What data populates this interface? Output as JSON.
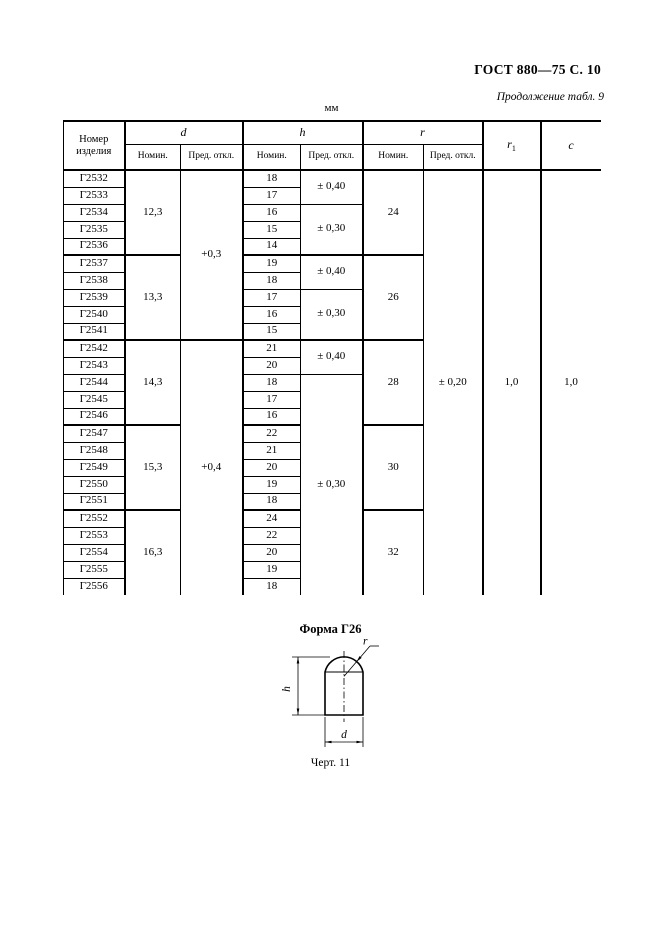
{
  "page": {
    "doc_ref": "ГОСТ 880—75 С. 10",
    "continuation": "Продолжение табл. 9",
    "units": "мм"
  },
  "table": {
    "header": {
      "product_line1": "Номер",
      "product_line2": "изделия",
      "col_d": "d",
      "col_h": "h",
      "col_r": "r",
      "col_r1_base": "r",
      "col_r1_sub": "1",
      "col_c": "c",
      "nominal": "Номин.",
      "tolerance": "Пред. откл."
    },
    "rows": [
      {
        "product": "Г2532",
        "h": "18"
      },
      {
        "product": "Г2533",
        "h": "17"
      },
      {
        "product": "Г2534",
        "h": "16"
      },
      {
        "product": "Г2535",
        "h": "15"
      },
      {
        "product": "Г2536",
        "h": "14"
      },
      {
        "product": "Г2537",
        "h": "19"
      },
      {
        "product": "Г2538",
        "h": "18"
      },
      {
        "product": "Г2539",
        "h": "17"
      },
      {
        "product": "Г2540",
        "h": "16"
      },
      {
        "product": "Г2541",
        "h": "15"
      },
      {
        "product": "Г2542",
        "h": "21"
      },
      {
        "product": "Г2543",
        "h": "20"
      },
      {
        "product": "Г2544",
        "h": "18"
      },
      {
        "product": "Г2545",
        "h": "17"
      },
      {
        "product": "Г2546",
        "h": "16"
      },
      {
        "product": "Г2547",
        "h": "22"
      },
      {
        "product": "Г2548",
        "h": "21"
      },
      {
        "product": "Г2549",
        "h": "20"
      },
      {
        "product": "Г2550",
        "h": "19"
      },
      {
        "product": "Г2551",
        "h": "18"
      },
      {
        "product": "Г2552",
        "h": "24"
      },
      {
        "product": "Г2553",
        "h": "22"
      },
      {
        "product": "Г2554",
        "h": "20"
      },
      {
        "product": "Г2555",
        "h": "19"
      },
      {
        "product": "Г2556",
        "h": "18"
      }
    ],
    "d_groups": [
      {
        "value": "12,3",
        "start": 0,
        "count": 5
      },
      {
        "value": "13,3",
        "start": 5,
        "count": 5
      },
      {
        "value": "14,3",
        "start": 10,
        "count": 5
      },
      {
        "value": "15,3",
        "start": 15,
        "count": 5
      },
      {
        "value": "16,3",
        "start": 20,
        "count": 5
      }
    ],
    "d_tol_groups": [
      {
        "value": "+0,3",
        "start": 0,
        "count": 10
      },
      {
        "value": "+0,4",
        "start": 10,
        "count": 15
      }
    ],
    "h_tol_groups": [
      {
        "value": "± 0,40",
        "start": 0,
        "count": 2
      },
      {
        "value": "± 0,30",
        "start": 2,
        "count": 3
      },
      {
        "value": "± 0,40",
        "start": 5,
        "count": 2
      },
      {
        "value": "± 0,30",
        "start": 7,
        "count": 3
      },
      {
        "value": "± 0,40",
        "start": 10,
        "count": 2
      },
      {
        "value": "± 0,30",
        "start": 12,
        "count": 13
      }
    ],
    "r_groups": [
      {
        "value": "24",
        "start": 0,
        "count": 5
      },
      {
        "value": "26",
        "start": 5,
        "count": 5
      },
      {
        "value": "28",
        "start": 10,
        "count": 5
      },
      {
        "value": "30",
        "start": 15,
        "count": 5
      },
      {
        "value": "32",
        "start": 20,
        "count": 5
      }
    ],
    "r_tol": "± 0,20",
    "r1_value": "1,0",
    "c_value": "1,0"
  },
  "figure": {
    "title": "Форма Г26",
    "caption": "Черт. 11",
    "label_h": "h",
    "label_d": "d",
    "label_r": "r"
  }
}
